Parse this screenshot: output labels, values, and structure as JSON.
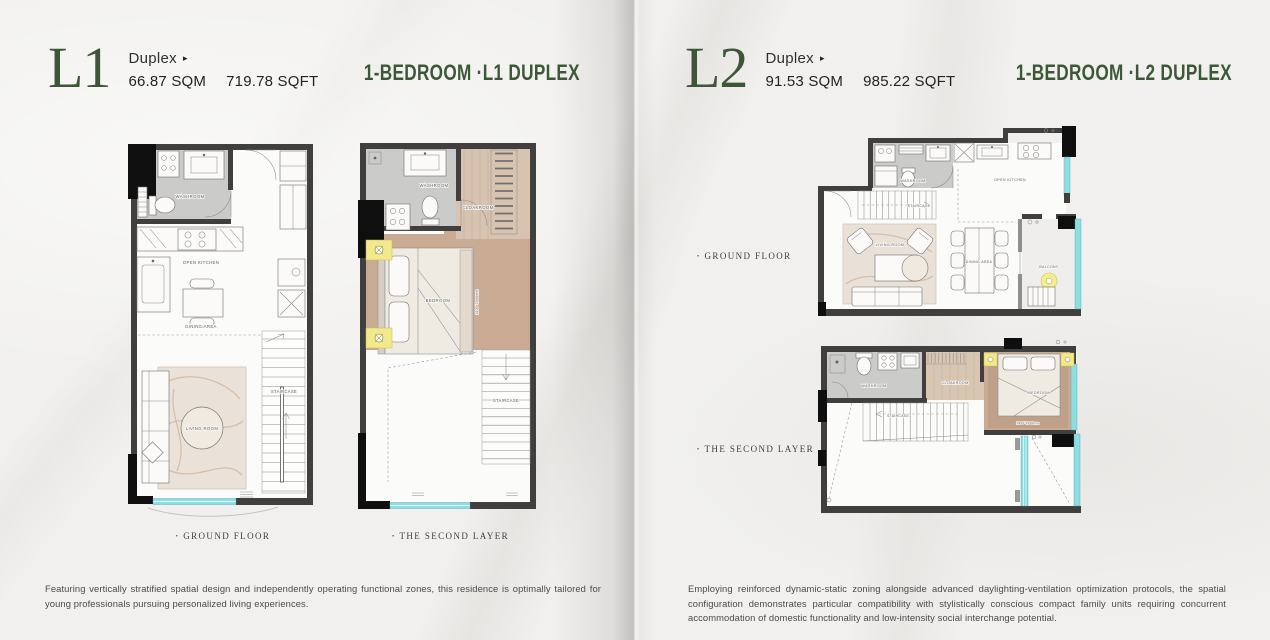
{
  "colors": {
    "accent_green": "#3e5838",
    "wall_dark": "#413f3d",
    "accent_black": "#0f0f0f",
    "glazing_teal": "#8ddde1",
    "wood_floor": "#c9ab93",
    "washroom_gray": "#cbcbc9",
    "lamp_yellow": "#f2e98c",
    "rug_beige": "#e9e1d7"
  },
  "left_page": {
    "unit": "L1",
    "unit_type": "Duplex",
    "unit_type_marker": "▸",
    "area_sqm": "66.87 SQM",
    "area_sqft": "719.78 SQFT",
    "title": "1-BEDROOM ·L1 DUPLEX",
    "captions": {
      "bullet": "•",
      "ground": "GROUND FLOOR",
      "second": "THE SECOND LAYER"
    },
    "description": "Featuring vertically stratified spatial design and independently operating functional zones, this residence is optimally tailored for young professionals pursuing personalized living experiences.",
    "plans": {
      "ground": {
        "washroom": "WASHROOM",
        "open_kitchen": "OPEN KITCHEN",
        "dining_area": "DINING AREA",
        "living_room": "LIVING ROOM",
        "staircase": "STAIRCASE"
      },
      "second": {
        "washroom": "WASHROOM",
        "cloakroom": "CLOAKROOM",
        "bedroom": "BEDROOM",
        "staircase": "STAIRCASE",
        "bed_size": "1800*2000mm"
      }
    }
  },
  "right_page": {
    "unit": "L2",
    "unit_type": "Duplex",
    "unit_type_marker": "▸",
    "area_sqm": "91.53 SQM",
    "area_sqft": "985.22 SQFT",
    "title": "1-BEDROOM ·L2 DUPLEX",
    "captions": {
      "bullet": "•",
      "ground": "GROUND FLOOR",
      "second": "THE SECOND LAYER"
    },
    "description": "Employing reinforced dynamic-static zoning alongside advanced daylighting-ventilation optimization protocols, the spatial configuration demonstrates particular compatibility with stylistically conscious compact family units requiring concurrent accommodation of domestic functionality and low-intensity social interchange potential.",
    "plans": {
      "ground": {
        "washroom": "WASHROOM",
        "open_kitchen": "OPEN KITCHEN",
        "staircase": "STAIRCASE",
        "living_room": "LIVING ROOM",
        "dining_area": "DINING AREA",
        "balcony": "BALCONY"
      },
      "second": {
        "washroom": "WASHROOM",
        "cloakroom": "CLOAKROOM",
        "bedroom": "BEDROOM",
        "staircase": "STAIRCASE",
        "bed_size": "1800*2000mm"
      }
    }
  }
}
